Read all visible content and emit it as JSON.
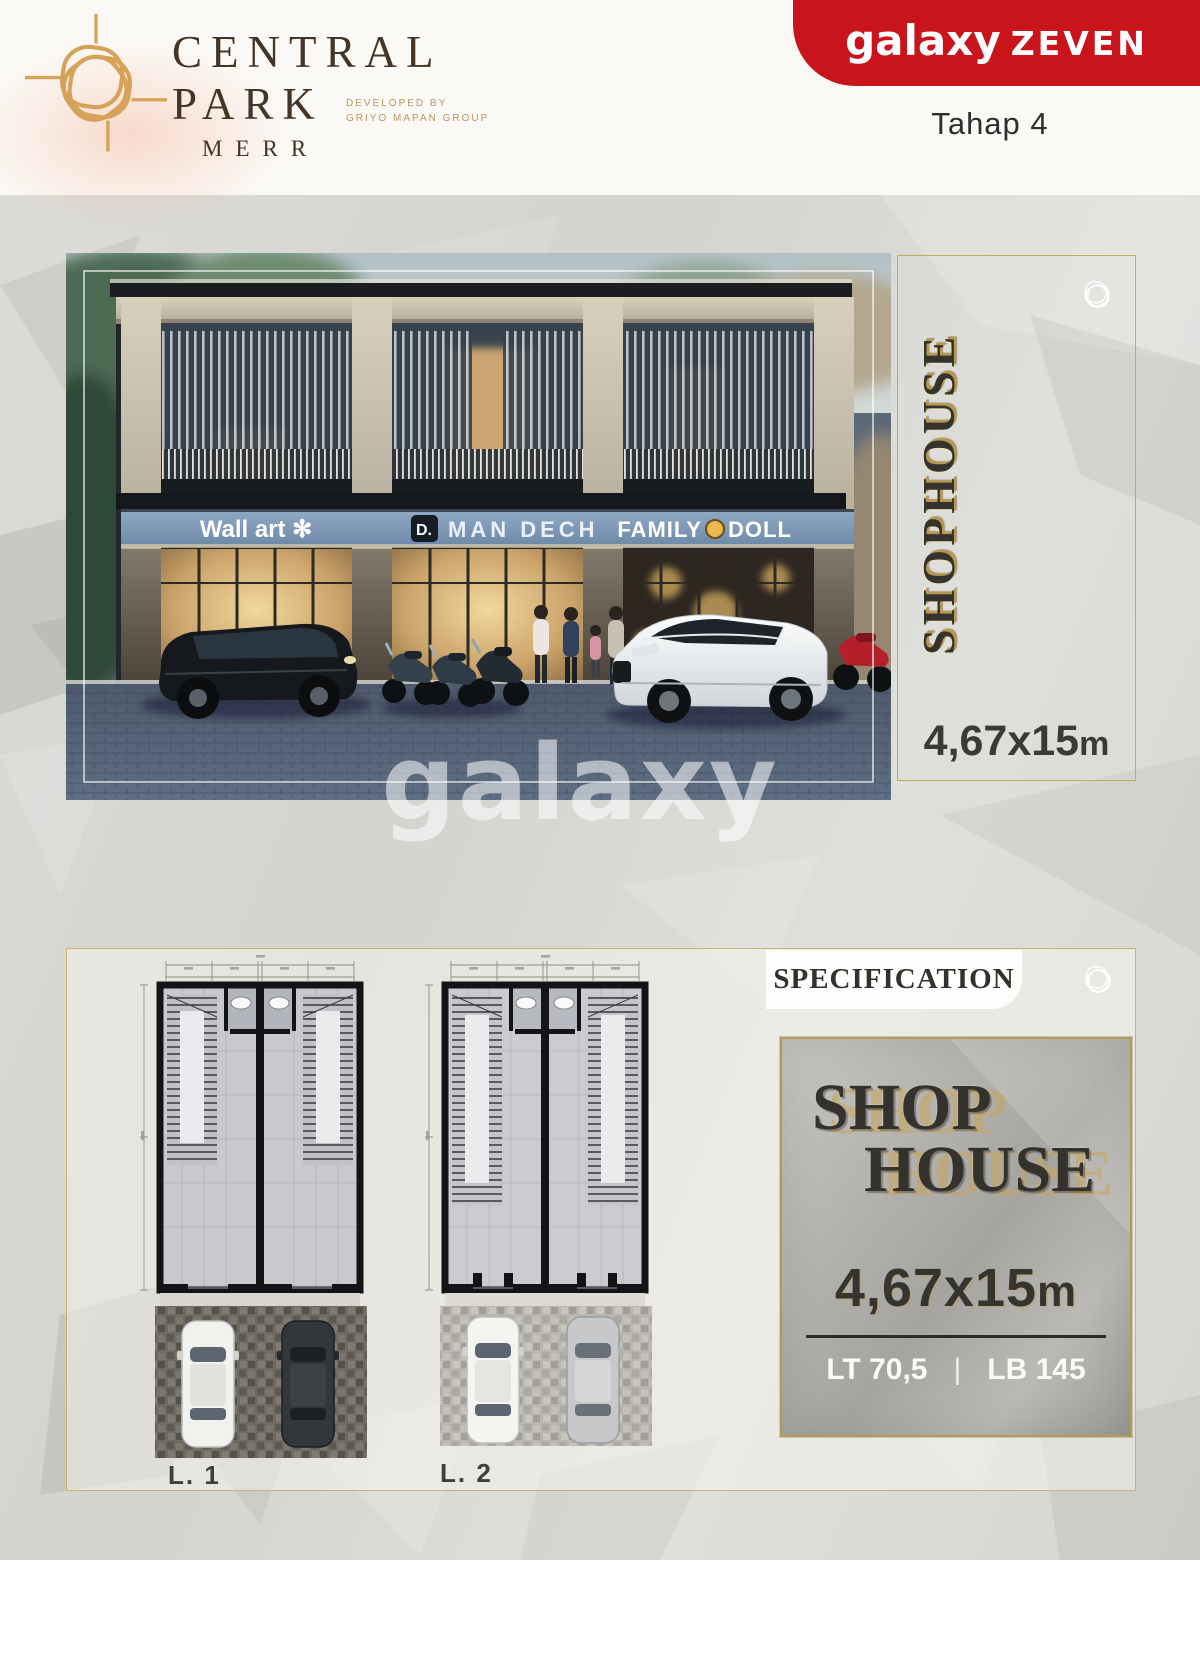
{
  "header": {
    "brand": {
      "line1": "CENTRAL",
      "line2": "PARK",
      "subtitle": "MERR",
      "developed_by": "DEVELOPED BY",
      "developer": "GRIYO MAPAN GROUP"
    },
    "ribbon": {
      "brand": "galaxy",
      "series": "ZEVEN"
    },
    "phase": "Tahap 4"
  },
  "hero": {
    "signs": {
      "sign1": "Wall art ✻",
      "sign2_badge": "D.",
      "sign2": "MAN DECH",
      "sign3_left": "FAMILY",
      "sign3_right": "DOLL"
    },
    "watermark": "galaxy",
    "panel": {
      "title": "SHOPHOUSE",
      "size": "4,67x15",
      "size_unit": "m"
    }
  },
  "plans": {
    "level1_label": "L. 1",
    "level2_label": "L. 2",
    "spec_header": "SPECIFICATION",
    "card": {
      "title1": "SHOP",
      "title2": "HOUSE",
      "size": "4,67x15",
      "size_unit": "m",
      "land": "LT 70,5",
      "separator": "|",
      "building": "LB 145"
    }
  },
  "colors": {
    "ribbon_red": "#c9141c",
    "gold_accent": "#c9a85c",
    "brand_brown": "#443527",
    "fascia_blue": "#7e98b8"
  }
}
